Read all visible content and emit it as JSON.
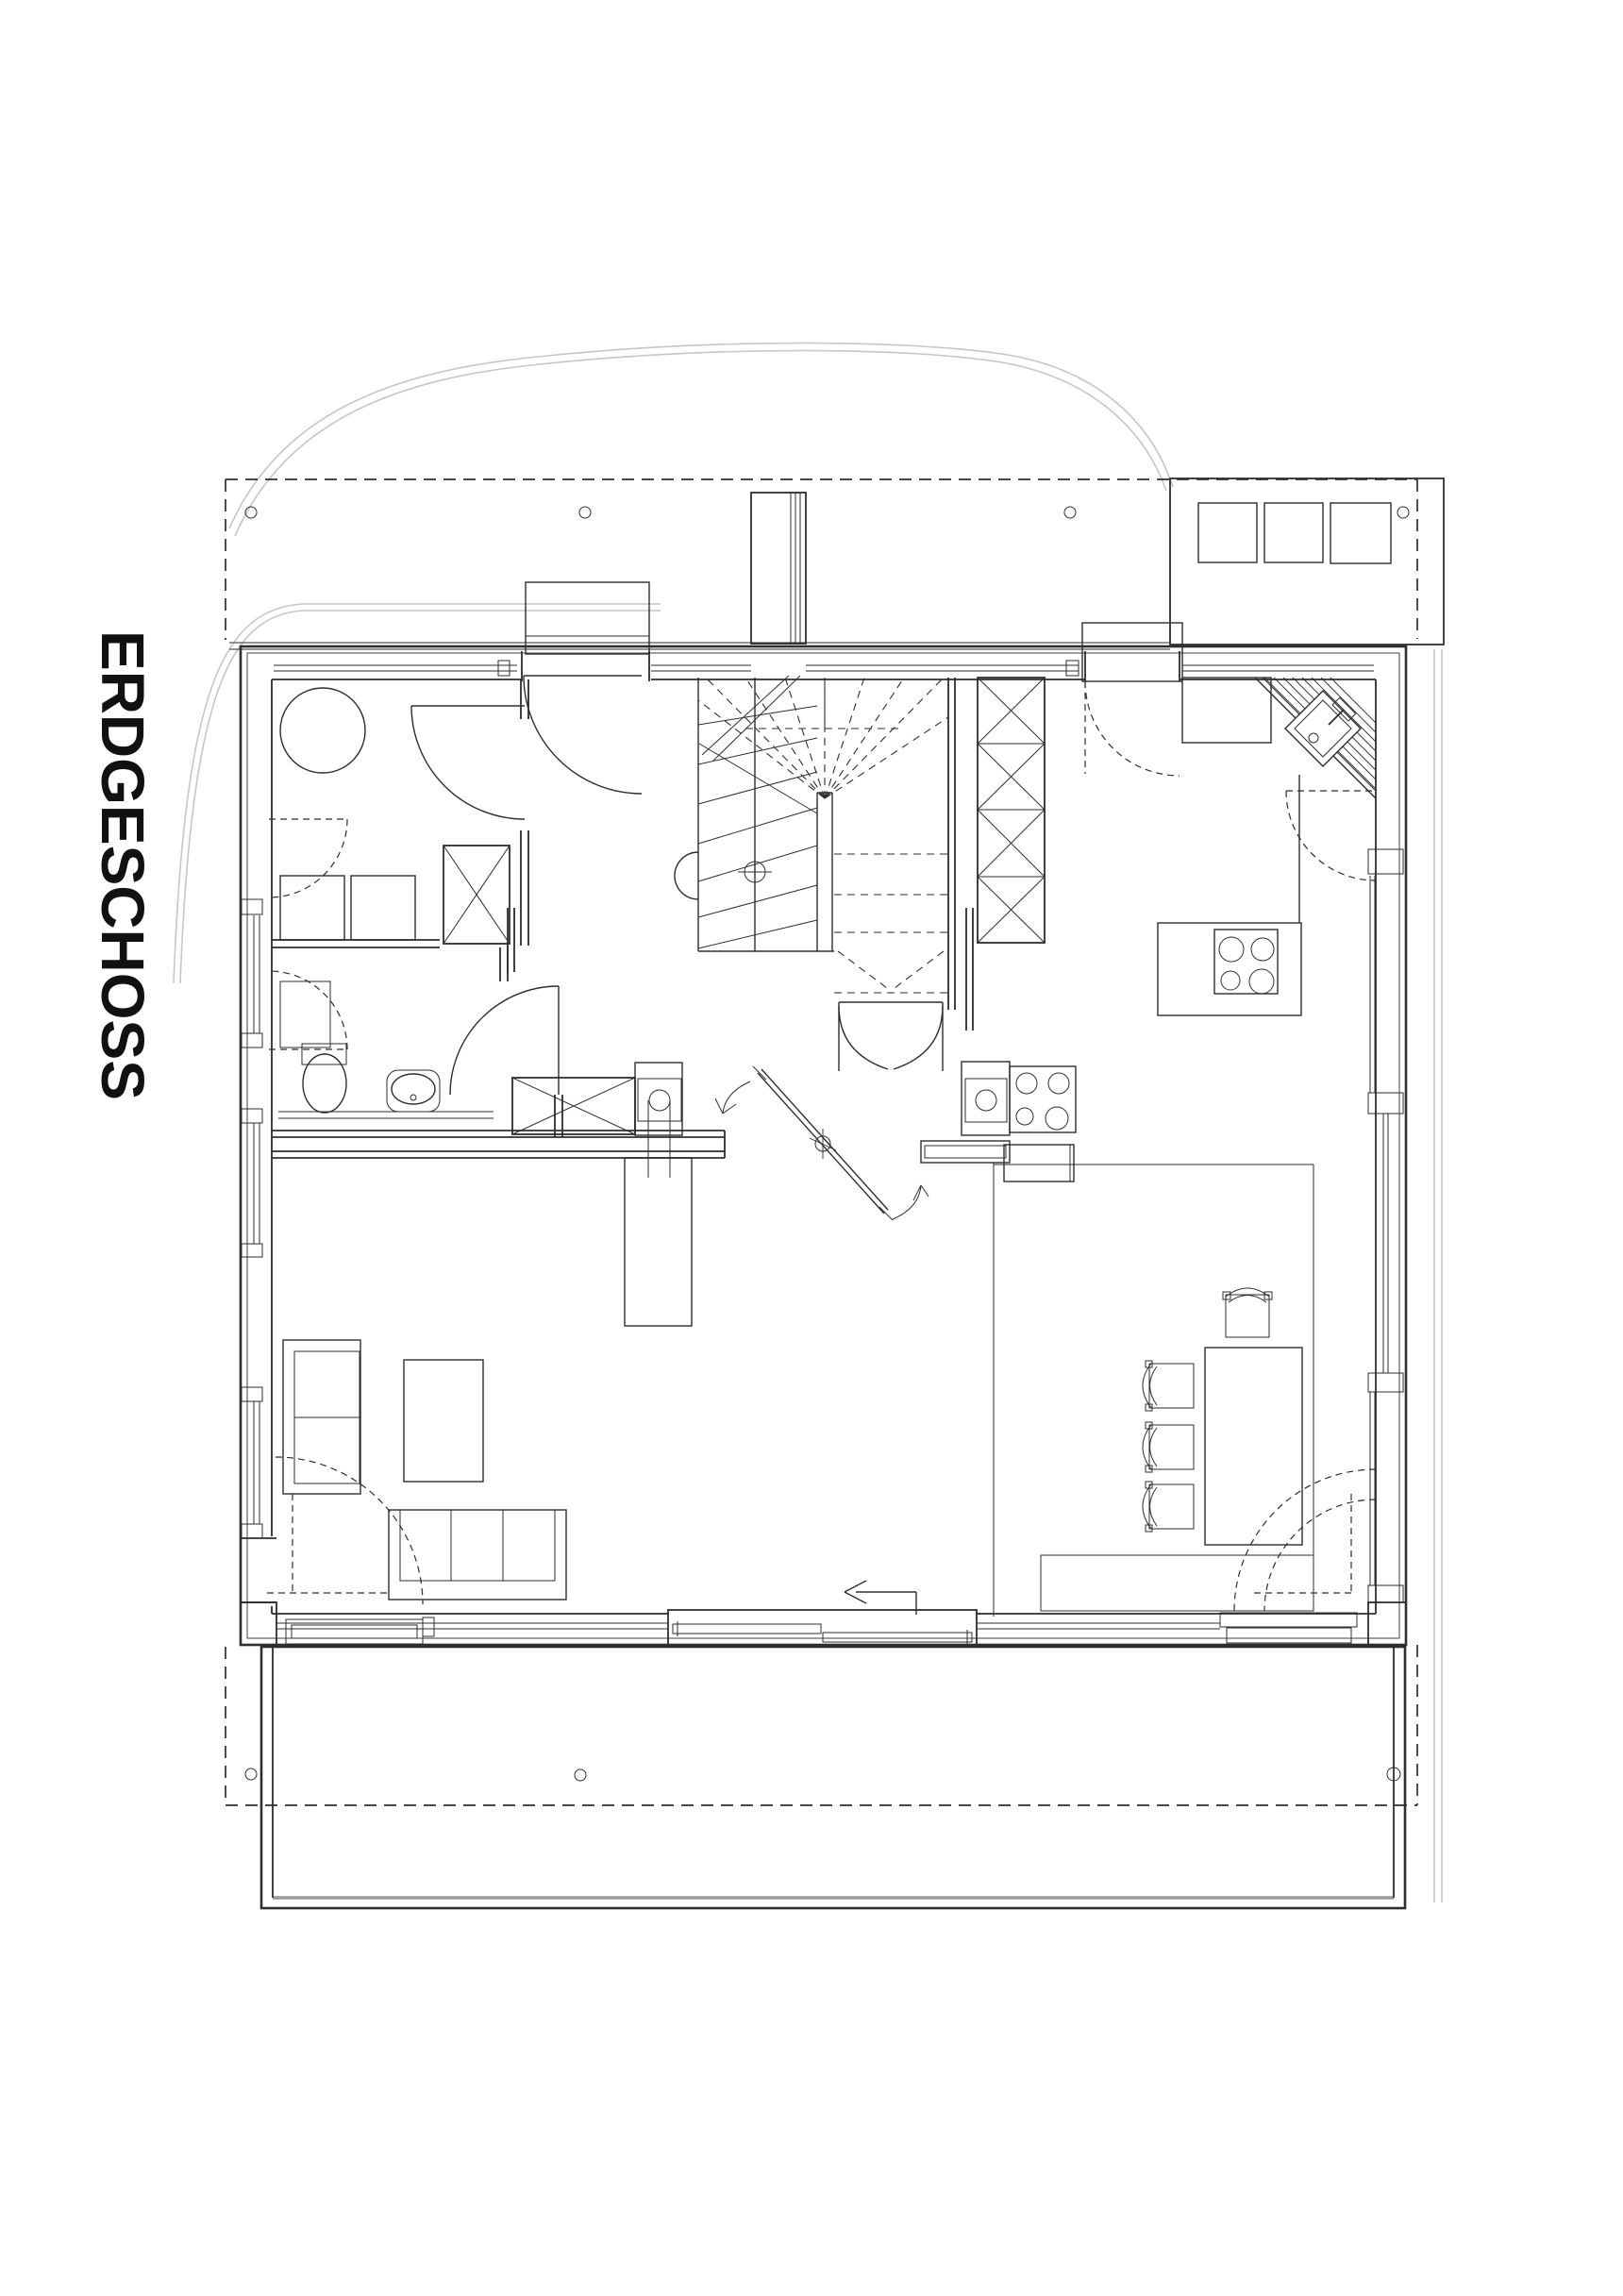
{
  "title": "ERDGESCHOSS",
  "colors": {
    "ink": "#2e2e2e",
    "site_gray": "#c6c6c6",
    "background": "#ffffff"
  },
  "plan": {
    "floor_label": "ERDGESCHOSS",
    "rooms": [
      {
        "name": "utility-room",
        "features": [
          "round-fixture",
          "washer",
          "dryer",
          "vent-shaft"
        ]
      },
      {
        "name": "wc",
        "features": [
          "toilet",
          "washbasin",
          "vanity-counter"
        ]
      },
      {
        "name": "hall",
        "features": [
          "winder-staircase",
          "double-swing-door",
          "column",
          "tall-cabinet"
        ]
      },
      {
        "name": "kitchen",
        "features": [
          "corner-sink",
          "cooktop-4-burner",
          "island-sink",
          "island-cooktop",
          "bar-counter"
        ]
      },
      {
        "name": "dining-area",
        "features": [
          "table",
          "chairs-4",
          "window-bench"
        ]
      },
      {
        "name": "living-area",
        "features": [
          "sofa-3-seat",
          "armchair",
          "coffee-table",
          "shelf-unit",
          "pivoting-partition"
        ]
      }
    ],
    "outdoor": [
      {
        "name": "upper-floor-overhang",
        "style": "dashed-outline",
        "posts": 7
      },
      {
        "name": "terrace-slab-south",
        "style": "solid-outline"
      },
      {
        "name": "storage-block-north-east",
        "skylights": 3
      },
      {
        "name": "chimney"
      },
      {
        "name": "site-canopy-curves",
        "style": "light-gray"
      }
    ],
    "annotations": [
      {
        "name": "sliding-door-arrow",
        "direction": "left"
      },
      {
        "name": "partition-swing-arrows",
        "count": 2
      }
    ]
  }
}
